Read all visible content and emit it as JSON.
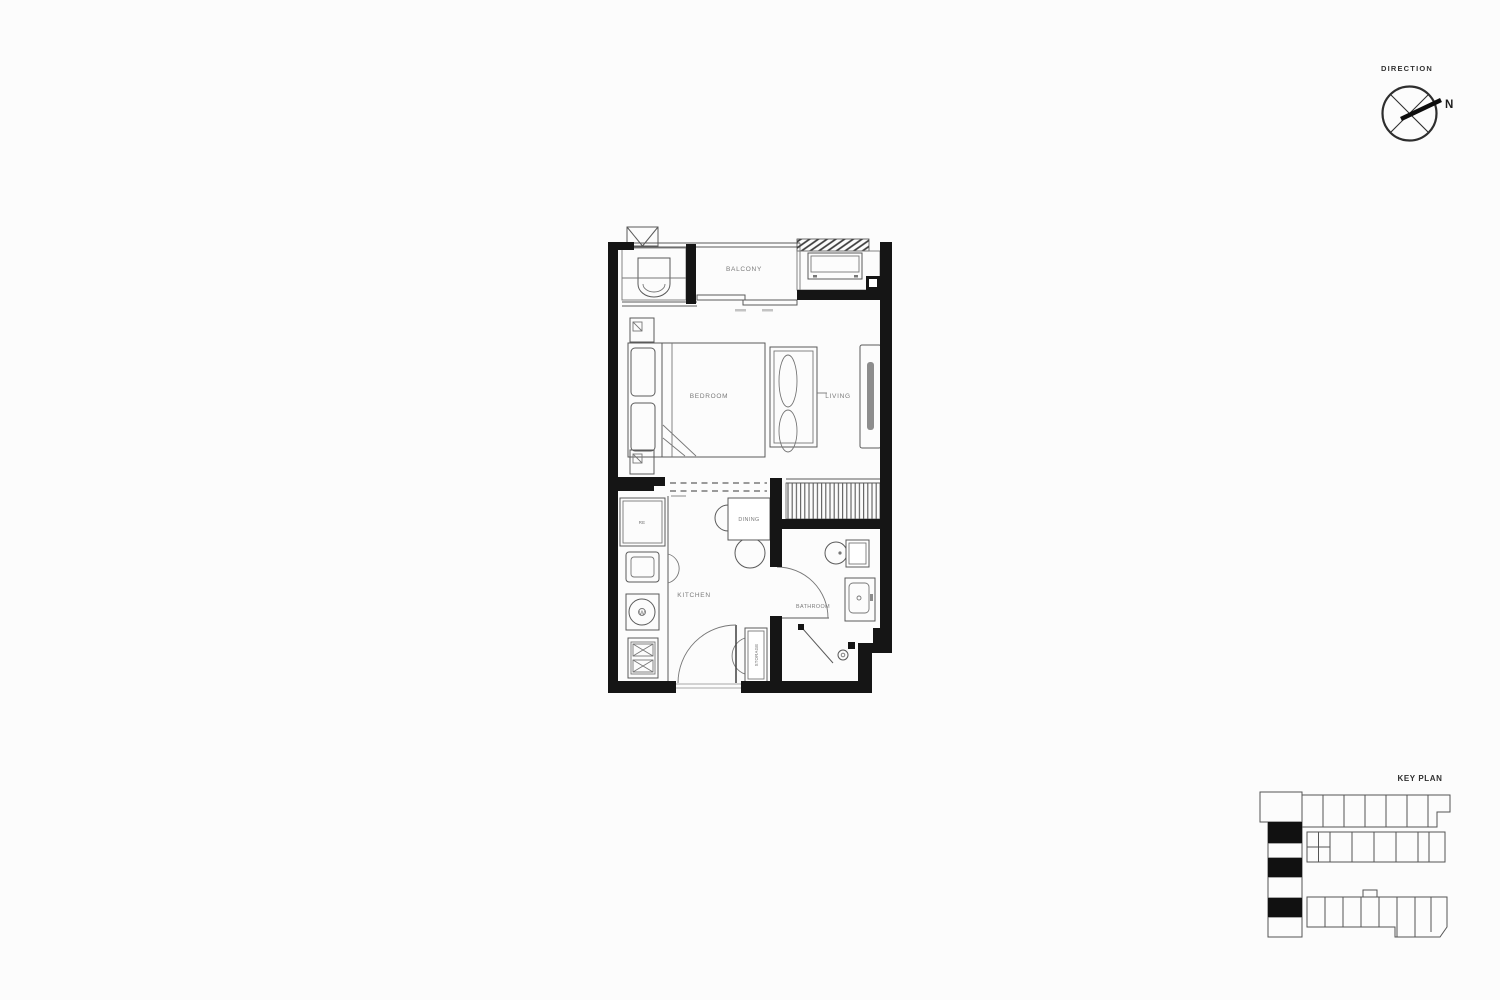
{
  "page": {
    "background": "#fcfcfc"
  },
  "direction_indicator": {
    "title": "DIRECTION",
    "north_label": "N"
  },
  "floor_plan": {
    "rooms": [
      {
        "id": "balcony",
        "label": "BALCONY"
      },
      {
        "id": "bedroom",
        "label": "BEDROOM"
      },
      {
        "id": "living",
        "label": "LIVING"
      },
      {
        "id": "dining",
        "label": "DINING"
      },
      {
        "id": "kitchen",
        "label": "KITCHEN"
      },
      {
        "id": "bathroom",
        "label": "BATHROOM"
      },
      {
        "id": "storage",
        "label": "STORAGE"
      }
    ],
    "appliance_labels": {
      "refrigerator": "RE",
      "washing_machine": "W"
    }
  },
  "key_plan": {
    "title": "KEY PLAN",
    "highlighted_unit_count": 3
  },
  "colors": {
    "wall": "#151515",
    "line": "#555555",
    "label": "#7a7a7a",
    "keyplan_highlight": "#111111"
  }
}
